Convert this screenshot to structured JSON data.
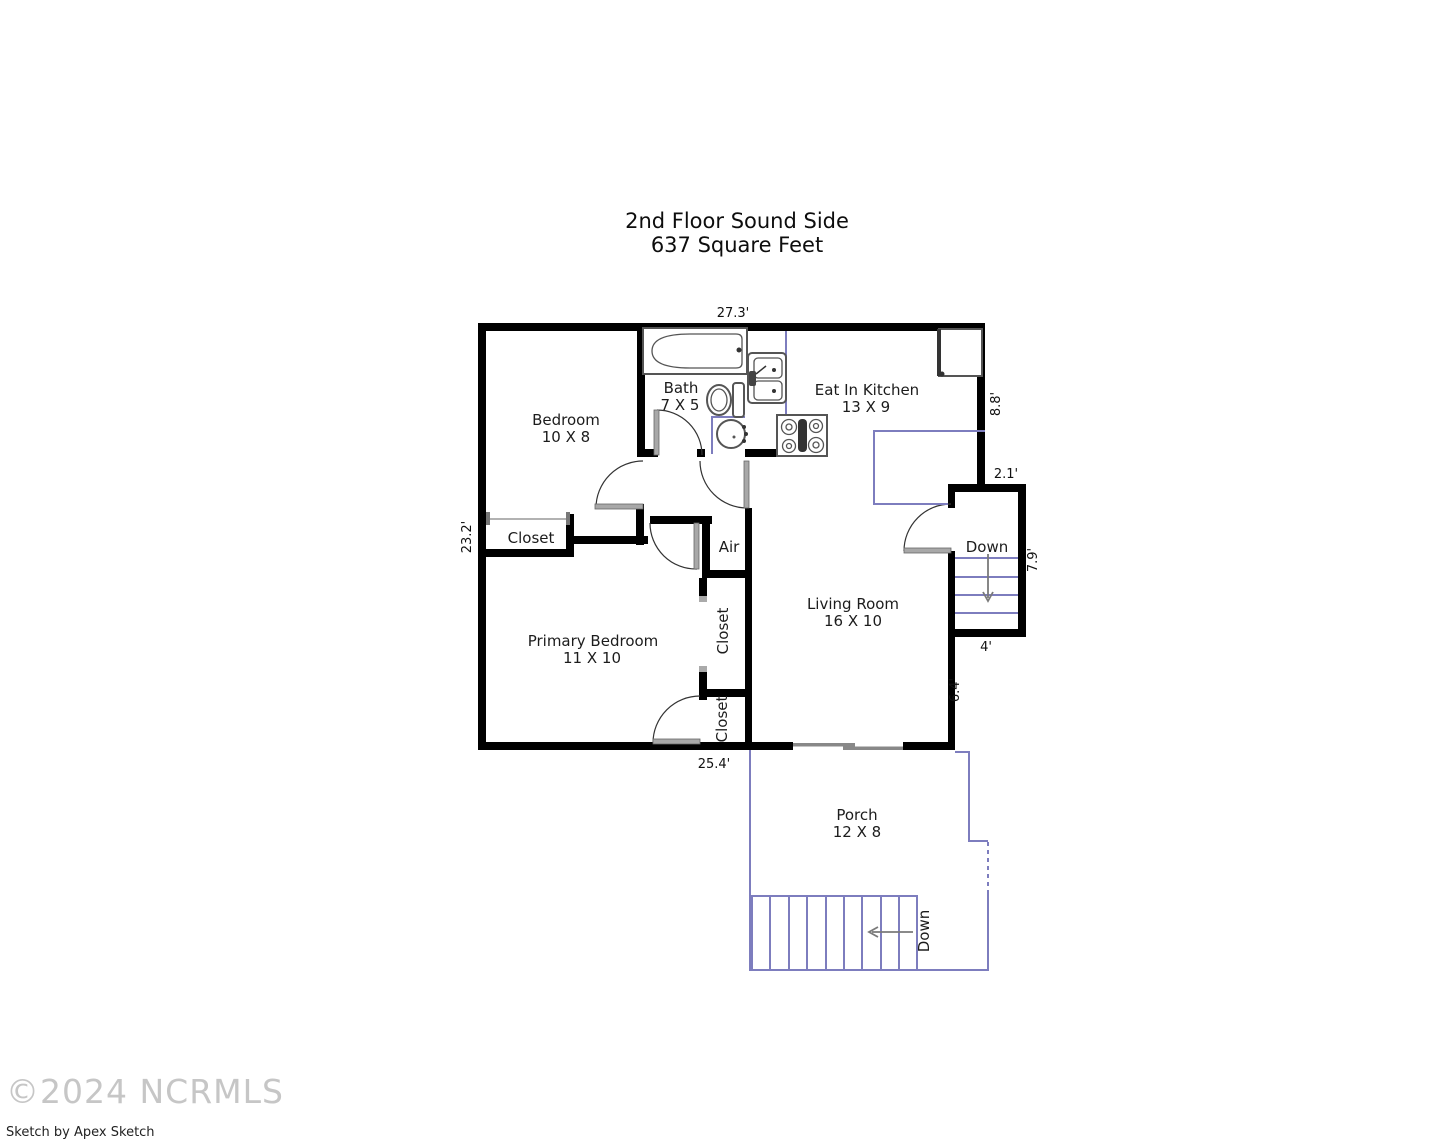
{
  "title": {
    "line1": "2nd Floor Sound Side",
    "line2": "637 Square Feet"
  },
  "rooms": {
    "bedroom": {
      "name": "Bedroom",
      "size": "10 X 8"
    },
    "bath": {
      "name": "Bath",
      "size": "7 X 5"
    },
    "kitchen": {
      "name": "Eat In Kitchen",
      "size": "13 X 9"
    },
    "closet_bedroom": {
      "name": "Closet"
    },
    "air": {
      "name": "Air"
    },
    "primary_bedroom": {
      "name": "Primary Bedroom",
      "size": "11 X 10"
    },
    "closet_upper": {
      "name": "Closet"
    },
    "closet_lower": {
      "name": "Closet"
    },
    "living": {
      "name": "Living Room",
      "size": "16 X 10"
    },
    "porch": {
      "name": "Porch",
      "size": "12 X 8"
    }
  },
  "stairs": {
    "interior_label": "Down",
    "porch_label": "Down"
  },
  "dimensions": {
    "top": "27.3'",
    "left": "23.2'",
    "kitchen_right": "8.8'",
    "stair_top": "2.1'",
    "stair_right": "7.9'",
    "stair_bottom": "4'",
    "living_right": "6.4'",
    "bottom": "25.4'"
  },
  "footer": {
    "copyright": "©2024 NCRMLS",
    "credit": "Sketch by Apex Sketch"
  },
  "colors": {
    "wall": "#000000",
    "accent_blue": "#7d7dbe",
    "fixture_gray": "#555555",
    "door_gray": "#a8a8a8"
  }
}
